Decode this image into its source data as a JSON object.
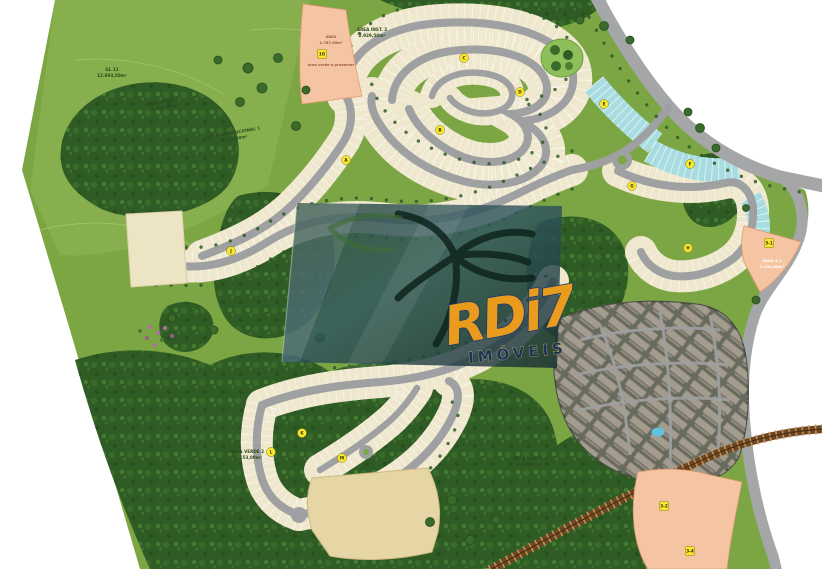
{
  "watermark": {
    "brand": "RDi7",
    "subtitle": "IMÓVEIS"
  },
  "labels": {
    "gl11": [
      "GL 11",
      "12.893,50m²"
    ],
    "area_verde_1": [
      "ÁREA VERDE 1",
      "13.414,20m²"
    ],
    "area_institucional_1": [
      "ÁREA INSTITUCIONAL 1",
      "8.502,50m²"
    ],
    "area_inst_2": [
      "ÁREA INST. 2",
      "2.929,50m²"
    ],
    "area_1g": [
      "ÁREA",
      "1.787,09m²",
      "área verde a preservar"
    ],
    "area_verde_2": [
      "ÁREA VERDE 2",
      "17.153,00m²"
    ],
    "area_verde_3": [
      "ÁREA VERDE 3",
      "9.415,00m²"
    ],
    "area_3_1": [
      "ÁREA 3-1",
      "2.150,00m²"
    ]
  },
  "badges": [
    {
      "label": "1G"
    },
    {
      "label": "A"
    },
    {
      "label": "B"
    },
    {
      "label": "C"
    },
    {
      "label": "D"
    },
    {
      "label": "E"
    },
    {
      "label": "F"
    },
    {
      "label": "G"
    },
    {
      "label": "H"
    },
    {
      "label": "3-1"
    },
    {
      "label": "J"
    },
    {
      "label": "K"
    },
    {
      "label": "L"
    },
    {
      "label": "M"
    },
    {
      "label": "3-2"
    },
    {
      "label": "3-4"
    }
  ],
  "colors": {
    "grass": "#7CA643",
    "forest": "#2F5C24",
    "road": "#9EA0A2",
    "residential_lot": "#EFE8CE",
    "commercial_lot": "#A7DCE0",
    "highlight_area": "#F5C4A2",
    "institutional_area": "#EDE4C4",
    "future_area": "#E6D5A5",
    "railroad": "#7A4F26",
    "badge": "#F7E733",
    "brand_orange": "#E89B1C",
    "brand_navy": "#1B3A6B"
  }
}
